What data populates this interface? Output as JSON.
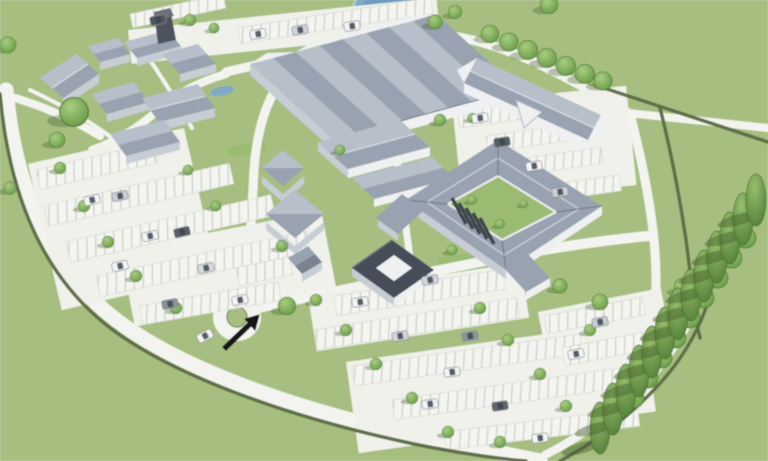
{
  "palette": {
    "grass": "#a6bf80",
    "lawn": "#9cbb72",
    "road": "#f3f4ef",
    "aisle": "#f0f1eb",
    "hedge": "#5f6f48",
    "wall": "#eef0f2",
    "wallShade": "#c7cdd4",
    "roofLight": "#b7bfca",
    "roofMid": "#98a2b1",
    "roofDark": "#7a8390",
    "roofDeep": "#474d58",
    "treeLight": "#a9cd81",
    "treeDark": "#679a45",
    "pond": "#7fa9c7",
    "arrow": "#161616",
    "carGlass": "#3c4450"
  },
  "scene": {
    "labels": {
      "site": "3D aerial masterplan rendering of a campus development with buildings, car parks, roads and trees",
      "ground": "grass ground plane",
      "pond": "pond",
      "roads": "access roads and footpaths",
      "roundabout": "entrance roundabout",
      "parking": "striped surface car parks with parked cars",
      "bigBuilding": "large multi-gabled industrial building",
      "ulCluster": "cluster of gabled village buildings",
      "trb": "long gabled building with cross gable",
      "quad": "courtyard quadrangle building complex",
      "uDark": "small dark-roofed courtyard annex",
      "treeAvenue": "diagonal avenue of tall trees with shadows",
      "arrow": "black arrow marking site entrance, pointing northeast",
      "field": "open green field",
      "hedges": "dark boundary hedgerows"
    }
  }
}
